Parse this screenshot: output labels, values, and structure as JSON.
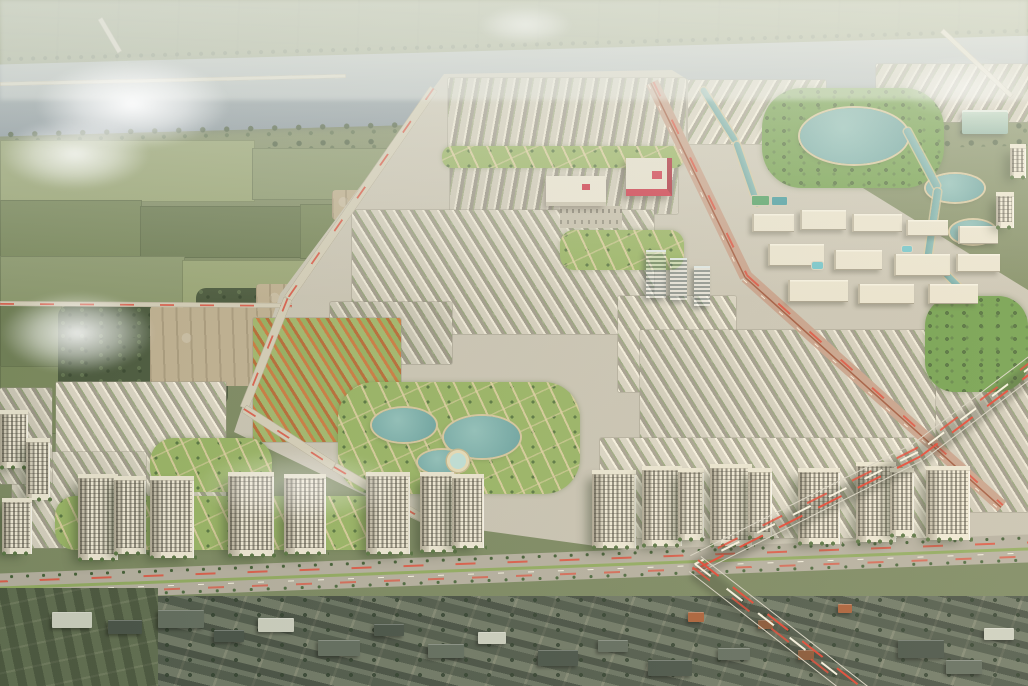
{
  "image": {
    "kind": "aerial-architectural-rendering",
    "subject": "Master-planned riverside township: river at top, farmland at left, dense townhouse rows with central park and lakes, row of cream apartment towers above a boulevard, expressway with light trails, existing village at bottom",
    "width": 1028,
    "height": 686
  },
  "palette": {
    "river": "#8c99a4",
    "farmland": "#7f8b64",
    "township_ground": "#cfc9ba",
    "row_wall": "#f2ecdc",
    "row_roof": "#a19b8d",
    "orange_roof": "#cd7a40",
    "park_green": "#6f9e4c",
    "pond_teal": "#7db4b0",
    "tower_wall": "#f0e9d7",
    "mall_red": "#cd3146",
    "road": "#b4aea0",
    "light_trail_red": "#e23e2d",
    "light_trail_white": "#fff9e8",
    "village_roof": "#414c43"
  },
  "formats": {
    "fields": "[x,y,w,h,shade]",
    "scrub_dirt": "[x,y,w,h]",
    "blocks": "[x,y,w,h,stripeDir(a|b|c|o),toneBrightness]",
    "parks": "[x,y,w,h,borderRadius,kind(trees|lawn)]",
    "ponds": "[x,y,w,h,kind(pond|pond-light)]",
    "campus_blocks": "[x,y,w,h]",
    "amenities": "[x,y,w,h,kind]",
    "malls": "[x,y,w,h,kind]",
    "glass_towers": "[x,y,w,h]",
    "towers": "[x,baseY,w,h]",
    "roads": "[x1,y1,x2,y2,width,kind]",
    "expressway": "[x1,y1,x2,y2,width]",
    "village_buildings": "[x,y,w,h,shade]",
    "clouds": "[x,y,w,h,opacity]"
  },
  "landscape": {
    "fields": [
      [
        0,
        140,
        255,
        62,
        2
      ],
      [
        252,
        148,
        200,
        52,
        0
      ],
      [
        0,
        200,
        142,
        58,
        1
      ],
      [
        140,
        206,
        165,
        52,
        3
      ],
      [
        300,
        204,
        135,
        55,
        1
      ],
      [
        0,
        256,
        185,
        50,
        0
      ],
      [
        182,
        260,
        150,
        46,
        2
      ],
      [
        0,
        304,
        62,
        64,
        3
      ],
      [
        0,
        366,
        60,
        68,
        1
      ]
    ],
    "scrub": [
      [
        58,
        306,
        140,
        95
      ],
      [
        96,
        338,
        132,
        68
      ],
      [
        196,
        288,
        84,
        40
      ]
    ],
    "dirt": [
      [
        150,
        306,
        122,
        80
      ],
      [
        256,
        284,
        62,
        34
      ],
      [
        332,
        190,
        38,
        30
      ]
    ],
    "clouds": [
      [
        35,
        58,
        195,
        92,
        0.95
      ],
      [
        0,
        118,
        150,
        72,
        0.8
      ],
      [
        0,
        292,
        155,
        82,
        0.88
      ],
      [
        195,
        448,
        210,
        75,
        0.4
      ],
      [
        478,
        6,
        95,
        38,
        0.5
      ],
      [
        895,
        56,
        135,
        62,
        0.42
      ]
    ]
  },
  "township": {
    "blocks": [
      [
        448,
        78,
        238,
        74,
        "c",
        1.0
      ],
      [
        450,
        156,
        228,
        58,
        "c",
        0.98
      ],
      [
        688,
        80,
        138,
        64,
        "b",
        1.02
      ],
      [
        876,
        64,
        152,
        58,
        "b",
        0.97
      ],
      [
        352,
        210,
        302,
        124,
        "a",
        1.0
      ],
      [
        330,
        302,
        122,
        62,
        "a",
        0.96
      ],
      [
        618,
        296,
        118,
        96,
        "a",
        1.02
      ],
      [
        640,
        330,
        312,
        116,
        "a",
        0.99
      ],
      [
        936,
        374,
        92,
        138,
        "a",
        0.97
      ],
      [
        600,
        438,
        338,
        100,
        "a",
        1.03
      ],
      [
        56,
        382,
        170,
        120,
        "a",
        1.04
      ],
      [
        12,
        452,
        134,
        96,
        "a",
        1.0
      ],
      [
        0,
        388,
        52,
        96,
        "a",
        0.97
      ],
      [
        253,
        318,
        148,
        124,
        "o",
        1.0
      ]
    ],
    "parks": [
      [
        762,
        88,
        182,
        100,
        40,
        "trees"
      ],
      [
        925,
        296,
        103,
        96,
        30,
        "trees"
      ],
      [
        338,
        382,
        242,
        112,
        36,
        "lawn"
      ],
      [
        150,
        438,
        122,
        54,
        24,
        "lawn"
      ],
      [
        55,
        496,
        345,
        54,
        20,
        "lawn"
      ],
      [
        560,
        230,
        124,
        40,
        14,
        "lawn"
      ],
      [
        442,
        146,
        242,
        22,
        10,
        "lawn"
      ]
    ],
    "ponds": [
      [
        372,
        408,
        64,
        34,
        "pond"
      ],
      [
        444,
        416,
        76,
        42,
        "pond"
      ],
      [
        418,
        450,
        48,
        24,
        "pond"
      ],
      [
        800,
        108,
        108,
        56,
        "pond"
      ],
      [
        926,
        174,
        58,
        28,
        "pond"
      ],
      [
        950,
        220,
        46,
        24,
        "pond"
      ],
      [
        447,
        450,
        22,
        22,
        "pond-light"
      ]
    ],
    "campus_blocks": [
      [
        752,
        214,
        42,
        18
      ],
      [
        800,
        210,
        46,
        20
      ],
      [
        852,
        214,
        50,
        18
      ],
      [
        906,
        220,
        42,
        16
      ],
      [
        958,
        226,
        40,
        18
      ],
      [
        768,
        244,
        56,
        22
      ],
      [
        834,
        250,
        48,
        20
      ],
      [
        894,
        254,
        56,
        22
      ],
      [
        956,
        254,
        44,
        18
      ],
      [
        788,
        280,
        60,
        22
      ],
      [
        858,
        284,
        56,
        20
      ],
      [
        928,
        284,
        50,
        20
      ]
    ],
    "amenities": [
      [
        812,
        262,
        11,
        7,
        "pool"
      ],
      [
        902,
        246,
        10,
        6,
        "pool"
      ],
      [
        752,
        196,
        17,
        9,
        "court-green"
      ],
      [
        772,
        197,
        15,
        8,
        "court-teal"
      ],
      [
        560,
        206,
        62,
        22,
        "lot"
      ],
      [
        962,
        110,
        46,
        24,
        "hall"
      ]
    ],
    "malls": [
      [
        626,
        158,
        46,
        38,
        "mall-red"
      ],
      [
        546,
        176,
        60,
        30,
        "mall-white"
      ]
    ],
    "glass_towers": [
      [
        646,
        250,
        20,
        48
      ],
      [
        670,
        258,
        17,
        42
      ],
      [
        694,
        266,
        16,
        40
      ]
    ]
  },
  "towers": [
    [
      0,
      468,
      28,
      58
    ],
    [
      26,
      500,
      24,
      62
    ],
    [
      2,
      554,
      30,
      56
    ],
    [
      78,
      560,
      40,
      86
    ],
    [
      114,
      554,
      32,
      78
    ],
    [
      150,
      558,
      44,
      82
    ],
    [
      228,
      556,
      46,
      84
    ],
    [
      284,
      554,
      42,
      80
    ],
    [
      366,
      554,
      44,
      82
    ],
    [
      420,
      552,
      34,
      80
    ],
    [
      452,
      548,
      32,
      74
    ],
    [
      592,
      548,
      44,
      78
    ],
    [
      642,
      546,
      40,
      80
    ],
    [
      678,
      540,
      26,
      72
    ],
    [
      710,
      546,
      42,
      82
    ],
    [
      748,
      538,
      24,
      70
    ],
    [
      798,
      544,
      42,
      76
    ],
    [
      856,
      542,
      40,
      80
    ],
    [
      890,
      536,
      24,
      68
    ],
    [
      926,
      540,
      44,
      74
    ],
    [
      1010,
      178,
      16,
      34
    ],
    [
      996,
      228,
      18,
      36
    ]
  ],
  "roads": [
    [
      0,
      84,
      346,
      76,
      4,
      "minor"
    ],
    [
      100,
      18,
      120,
      52,
      5,
      "minor"
    ],
    [
      942,
      30,
      1012,
      96,
      5,
      "minor"
    ],
    [
      0,
      303,
      292,
      305,
      5,
      "trail"
    ],
    [
      434,
      88,
      288,
      298,
      9,
      "trail"
    ],
    [
      288,
      298,
      244,
      408,
      9,
      "trail"
    ],
    [
      244,
      408,
      334,
      466,
      9,
      "trail"
    ],
    [
      334,
      466,
      440,
      528,
      9,
      "trail"
    ],
    [
      652,
      82,
      746,
      276,
      13,
      "artery"
    ],
    [
      746,
      276,
      1002,
      506,
      13,
      "artery"
    ],
    [
      702,
      88,
      736,
      142,
      6,
      "canal"
    ],
    [
      736,
      142,
      758,
      206,
      6,
      "canal"
    ],
    [
      906,
      128,
      938,
      188,
      7,
      "canal"
    ],
    [
      938,
      188,
      928,
      256,
      7,
      "canal"
    ],
    [
      928,
      256,
      972,
      300,
      6,
      "canal"
    ],
    [
      -12,
      588,
      1040,
      548,
      28,
      "avenue"
    ]
  ],
  "expressway": [
    [
      1040,
      360,
      918,
      452,
      20
    ],
    [
      918,
      452,
      695,
      564,
      20
    ],
    [
      695,
      564,
      862,
      694,
      20
    ]
  ],
  "village": {
    "buildings": [
      [
        52,
        612,
        40,
        16,
        2
      ],
      [
        108,
        620,
        34,
        14,
        0
      ],
      [
        158,
        610,
        46,
        18,
        1
      ],
      [
        214,
        630,
        30,
        12,
        0
      ],
      [
        258,
        618,
        36,
        14,
        2
      ],
      [
        318,
        640,
        42,
        16,
        1
      ],
      [
        374,
        624,
        30,
        12,
        0
      ],
      [
        428,
        644,
        36,
        14,
        1
      ],
      [
        478,
        632,
        28,
        12,
        2
      ],
      [
        538,
        650,
        40,
        16,
        0
      ],
      [
        598,
        640,
        30,
        12,
        1
      ],
      [
        648,
        660,
        44,
        16,
        0
      ],
      [
        718,
        648,
        32,
        12,
        1
      ],
      [
        898,
        640,
        46,
        18,
        0
      ],
      [
        946,
        660,
        36,
        14,
        1
      ],
      [
        984,
        628,
        30,
        12,
        2
      ],
      [
        688,
        612,
        16,
        10,
        3
      ],
      [
        758,
        620,
        15,
        9,
        3
      ],
      [
        798,
        650,
        16,
        10,
        3
      ],
      [
        838,
        604,
        14,
        9,
        3
      ]
    ]
  }
}
